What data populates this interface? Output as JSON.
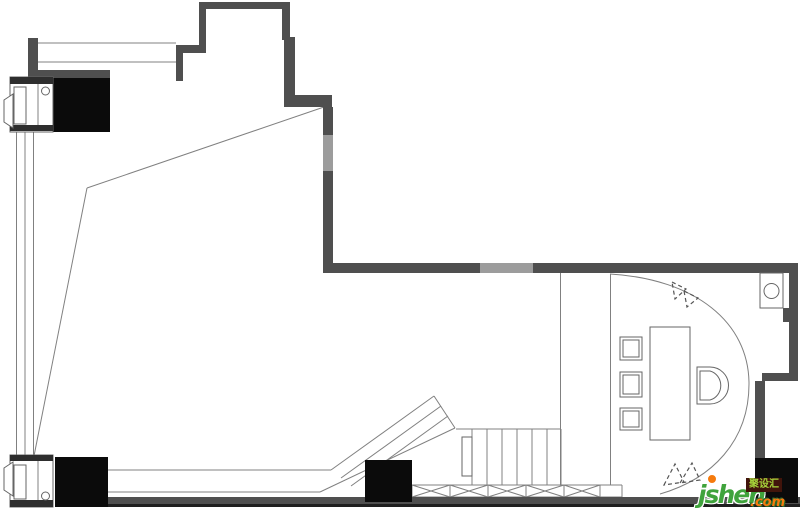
{
  "watermark": {
    "site": "jsheh",
    "tld": ".com",
    "badge": "聚设汇"
  },
  "colors": {
    "background": "#ffffff",
    "wall": "#4f4f4f",
    "wall_dark_edge": "#1f1f1f",
    "column": "#0b0b0b",
    "opening": "#9c9c9c",
    "line": "#808080",
    "fixture_line": "#666666",
    "dash_line": "#555555",
    "watermark_green": "#3fa33c",
    "watermark_orange": "#f57a0d",
    "badge_bg": "#41140b",
    "badge_text": "#a6d33a"
  }
}
